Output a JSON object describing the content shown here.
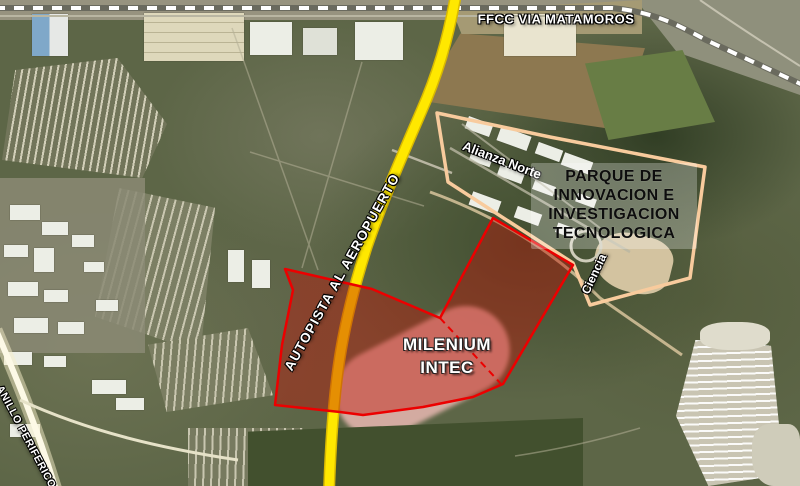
{
  "map": {
    "railway_label": "FFCC VIA MATAMOROS",
    "highway_label": "AUTOPISTA AL AEROPUERTO",
    "ring_road_label": "ANILLO PERIFERICO",
    "district_label": "Alianza Norte",
    "street_label": "Ciencia",
    "site_label_lines": [
      "MILENIUM",
      "INTEC"
    ],
    "park_label_lines": [
      "PARQUE DE",
      "INNOVACION E",
      "INVESTIGACION",
      "TECNOLOGICA"
    ],
    "colors": {
      "highway_yellow": "#ffe800",
      "highway_casing": "#d9b900",
      "railway_dash_white": "#ffffff",
      "railway_base": "#6a6a5e",
      "site_fill_red": "#c01408",
      "site_border_red": "#ec0000",
      "park_outline_peach": "#f8cb9d",
      "label_white": "#ffffff",
      "label_black": "#111111"
    }
  }
}
